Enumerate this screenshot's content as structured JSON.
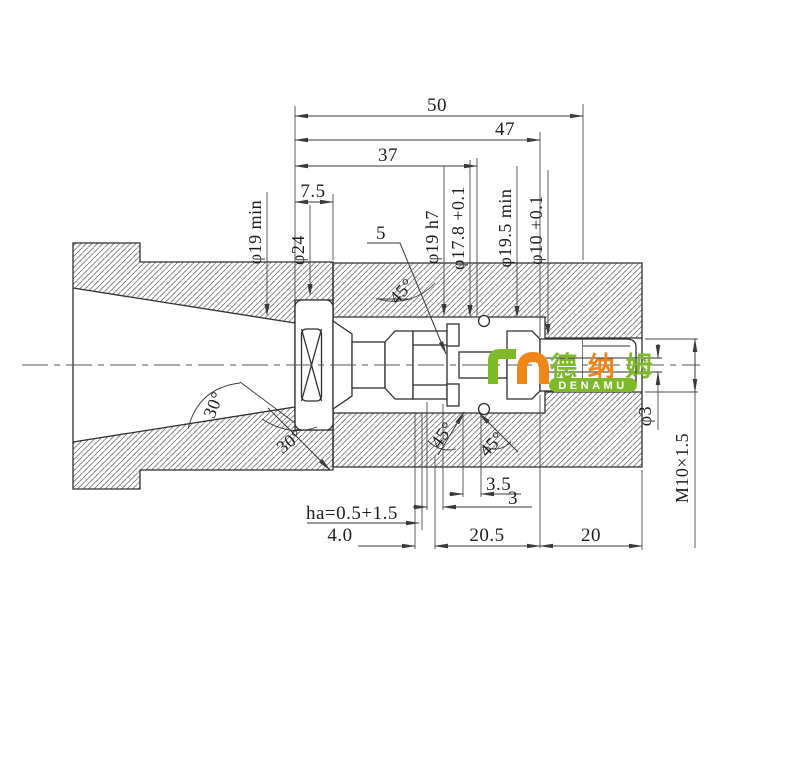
{
  "dims": {
    "len50": "50",
    "len47": "47",
    "len37": "37",
    "len75": "7.5",
    "len205": "20.5",
    "len20": "20",
    "len40": "4.0",
    "len35": "3.5",
    "len3": "3",
    "ha": "ha=0.5+1.5",
    "chamfer5": "5"
  },
  "diameters": {
    "phi19min": "φ19 min",
    "phi24": "φ24",
    "phi19h7": "φ19 h7",
    "phi178": "φ17.8 +0.1",
    "phi195min": "φ19.5 min",
    "phi10": "φ10 +0.1",
    "phi3": "φ3",
    "thread": "M10×1.5"
  },
  "angles": {
    "taper30a": "30°",
    "taper30b": "30°",
    "chamfer45a": "45°",
    "chamfer45b": "45°",
    "chamfer45c": "45°"
  },
  "logo": {
    "cn1": "德",
    "cn2": "纳",
    "cn3": "姆",
    "latin": "DENAMU",
    "green": "#7db928",
    "orange": "#f08519"
  },
  "colors": {
    "outline": "#2f2f2f",
    "dimension": "#4a4a4a",
    "hatch": "#707070",
    "background": "#ffffff"
  }
}
